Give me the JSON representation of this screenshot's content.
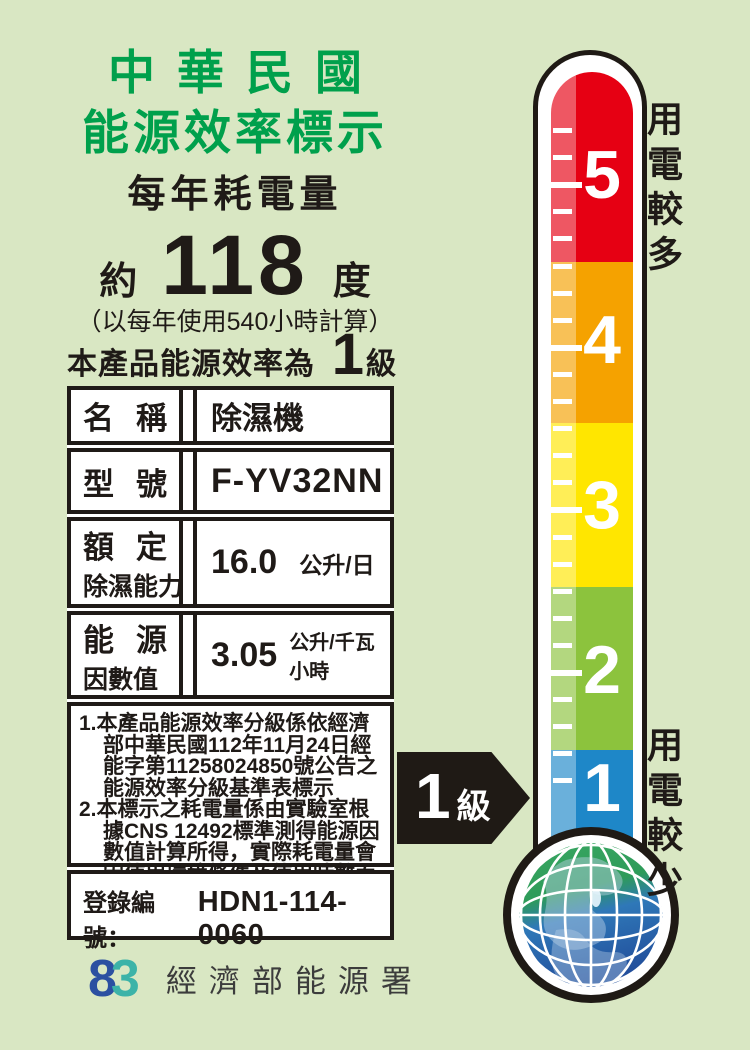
{
  "header": {
    "title_line1": "中華民國",
    "title_line2": "能源效率標示",
    "subtitle": "每年耗電量"
  },
  "consumption": {
    "prefix": "約",
    "value": "118",
    "unit": "度",
    "calc_note": "（以每年使用540小時計算）"
  },
  "grade_line": {
    "prefix": "本產品能源效率為第",
    "grade": "1",
    "suffix": "級"
  },
  "spec_table": {
    "rows": [
      {
        "label_a": "名",
        "label_b": "稱",
        "label_sub": "",
        "value": "除濕機",
        "unit": ""
      },
      {
        "label_a": "型",
        "label_b": "號",
        "label_sub": "",
        "value": "F-YV32NN",
        "unit": ""
      },
      {
        "label_a": "額",
        "label_b": "定",
        "label_sub": "除濕能力",
        "value": "16.0",
        "unit": "公升/日"
      },
      {
        "label_a": "能",
        "label_b": "源",
        "label_sub": "因數值",
        "value": "3.05",
        "unit": "公升/千瓦小時"
      }
    ]
  },
  "notes": {
    "items": [
      {
        "num": "1.",
        "text": "本產品能源效率分級係依經濟部中華民國112年11月24日經能字第11258024850號公告之能源效率分級基準表標示"
      },
      {
        "num": "2.",
        "text": "本標示之耗電量係由實驗室根據CNS 12492標準測得能源因數值計算所得，實際耗電量會因使用環境條件及使用時數而有所差異。"
      }
    ]
  },
  "registration": {
    "label": "登錄編號：",
    "value": "HDN1-114-0060"
  },
  "footer": {
    "agency": "經濟部能源署",
    "logo_glyph_left": "8",
    "logo_glyph_right": "3"
  },
  "thermometer": {
    "top_label": "用電較多",
    "bottom_label": "用電較少",
    "arrow_value": "1",
    "arrow_suffix": "級",
    "levels": [
      {
        "value": "5",
        "color": "#e60013"
      },
      {
        "value": "4",
        "color": "#f5a200"
      },
      {
        "value": "3",
        "color": "#ffe600"
      },
      {
        "value": "2",
        "color": "#8cc33d"
      },
      {
        "value": "1",
        "color": "#1e87c8"
      }
    ],
    "globe_colors": {
      "top": "#2e9b59",
      "bottom": "#2a5dab"
    }
  }
}
